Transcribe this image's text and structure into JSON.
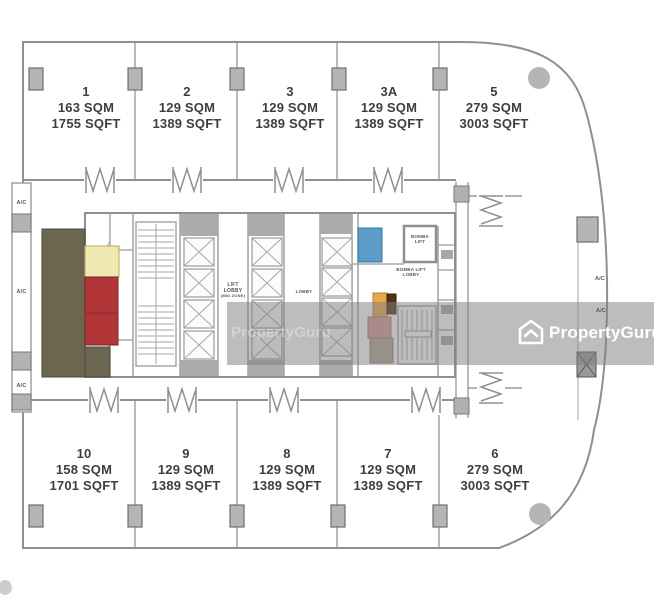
{
  "watermark": {
    "brand": "PropertyGuru",
    "faint_brand": "PropertyGuru"
  },
  "plan": {
    "units_top": [
      {
        "no": "1",
        "sqm": "163 SQM",
        "sqft": "1755 SQFT"
      },
      {
        "no": "2",
        "sqm": "129 SQM",
        "sqft": "1389 SQFT"
      },
      {
        "no": "3",
        "sqm": "129 SQM",
        "sqft": "1389 SQFT"
      },
      {
        "no": "3A",
        "sqm": "129 SQM",
        "sqft": "1389 SQFT"
      },
      {
        "no": "5",
        "sqm": "279 SQM",
        "sqft": "3003 SQFT"
      }
    ],
    "units_bottom": [
      {
        "no": "10",
        "sqm": "158 SQM",
        "sqft": "1701 SQFT"
      },
      {
        "no": "9",
        "sqm": "129 SQM",
        "sqft": "1389 SQFT"
      },
      {
        "no": "8",
        "sqm": "129 SQM",
        "sqft": "1389 SQFT"
      },
      {
        "no": "7",
        "sqm": "129 SQM",
        "sqft": "1389 SQFT"
      },
      {
        "no": "6",
        "sqm": "279 SQM",
        "sqft": "3003 SQFT"
      }
    ],
    "labels": {
      "lift": "LIFT",
      "lobby": "LOBBY",
      "lift_zone": "(MID ZONE)",
      "small_lobby": "LOBBY",
      "bomba": "BOMBA",
      "bomba_lift": "LIFT",
      "bomba_lobby_line1": "BOMBA LIFT",
      "bomba_lobby_line2": "LOBBY",
      "ac": "A/C"
    },
    "colors": {
      "wall": "#8f8f8f",
      "column": "#b5b5b5",
      "olive": "#6b664f",
      "yellow": "#f0e8b2",
      "red": "#b23538",
      "blue": "#5b9cc9",
      "orange": "#e9a84d",
      "brown": "#503313",
      "pink": "#d69a94",
      "tan": "#b1a392",
      "text": "#3e3e3e",
      "band": "rgba(128,128,128,0.52)"
    }
  }
}
